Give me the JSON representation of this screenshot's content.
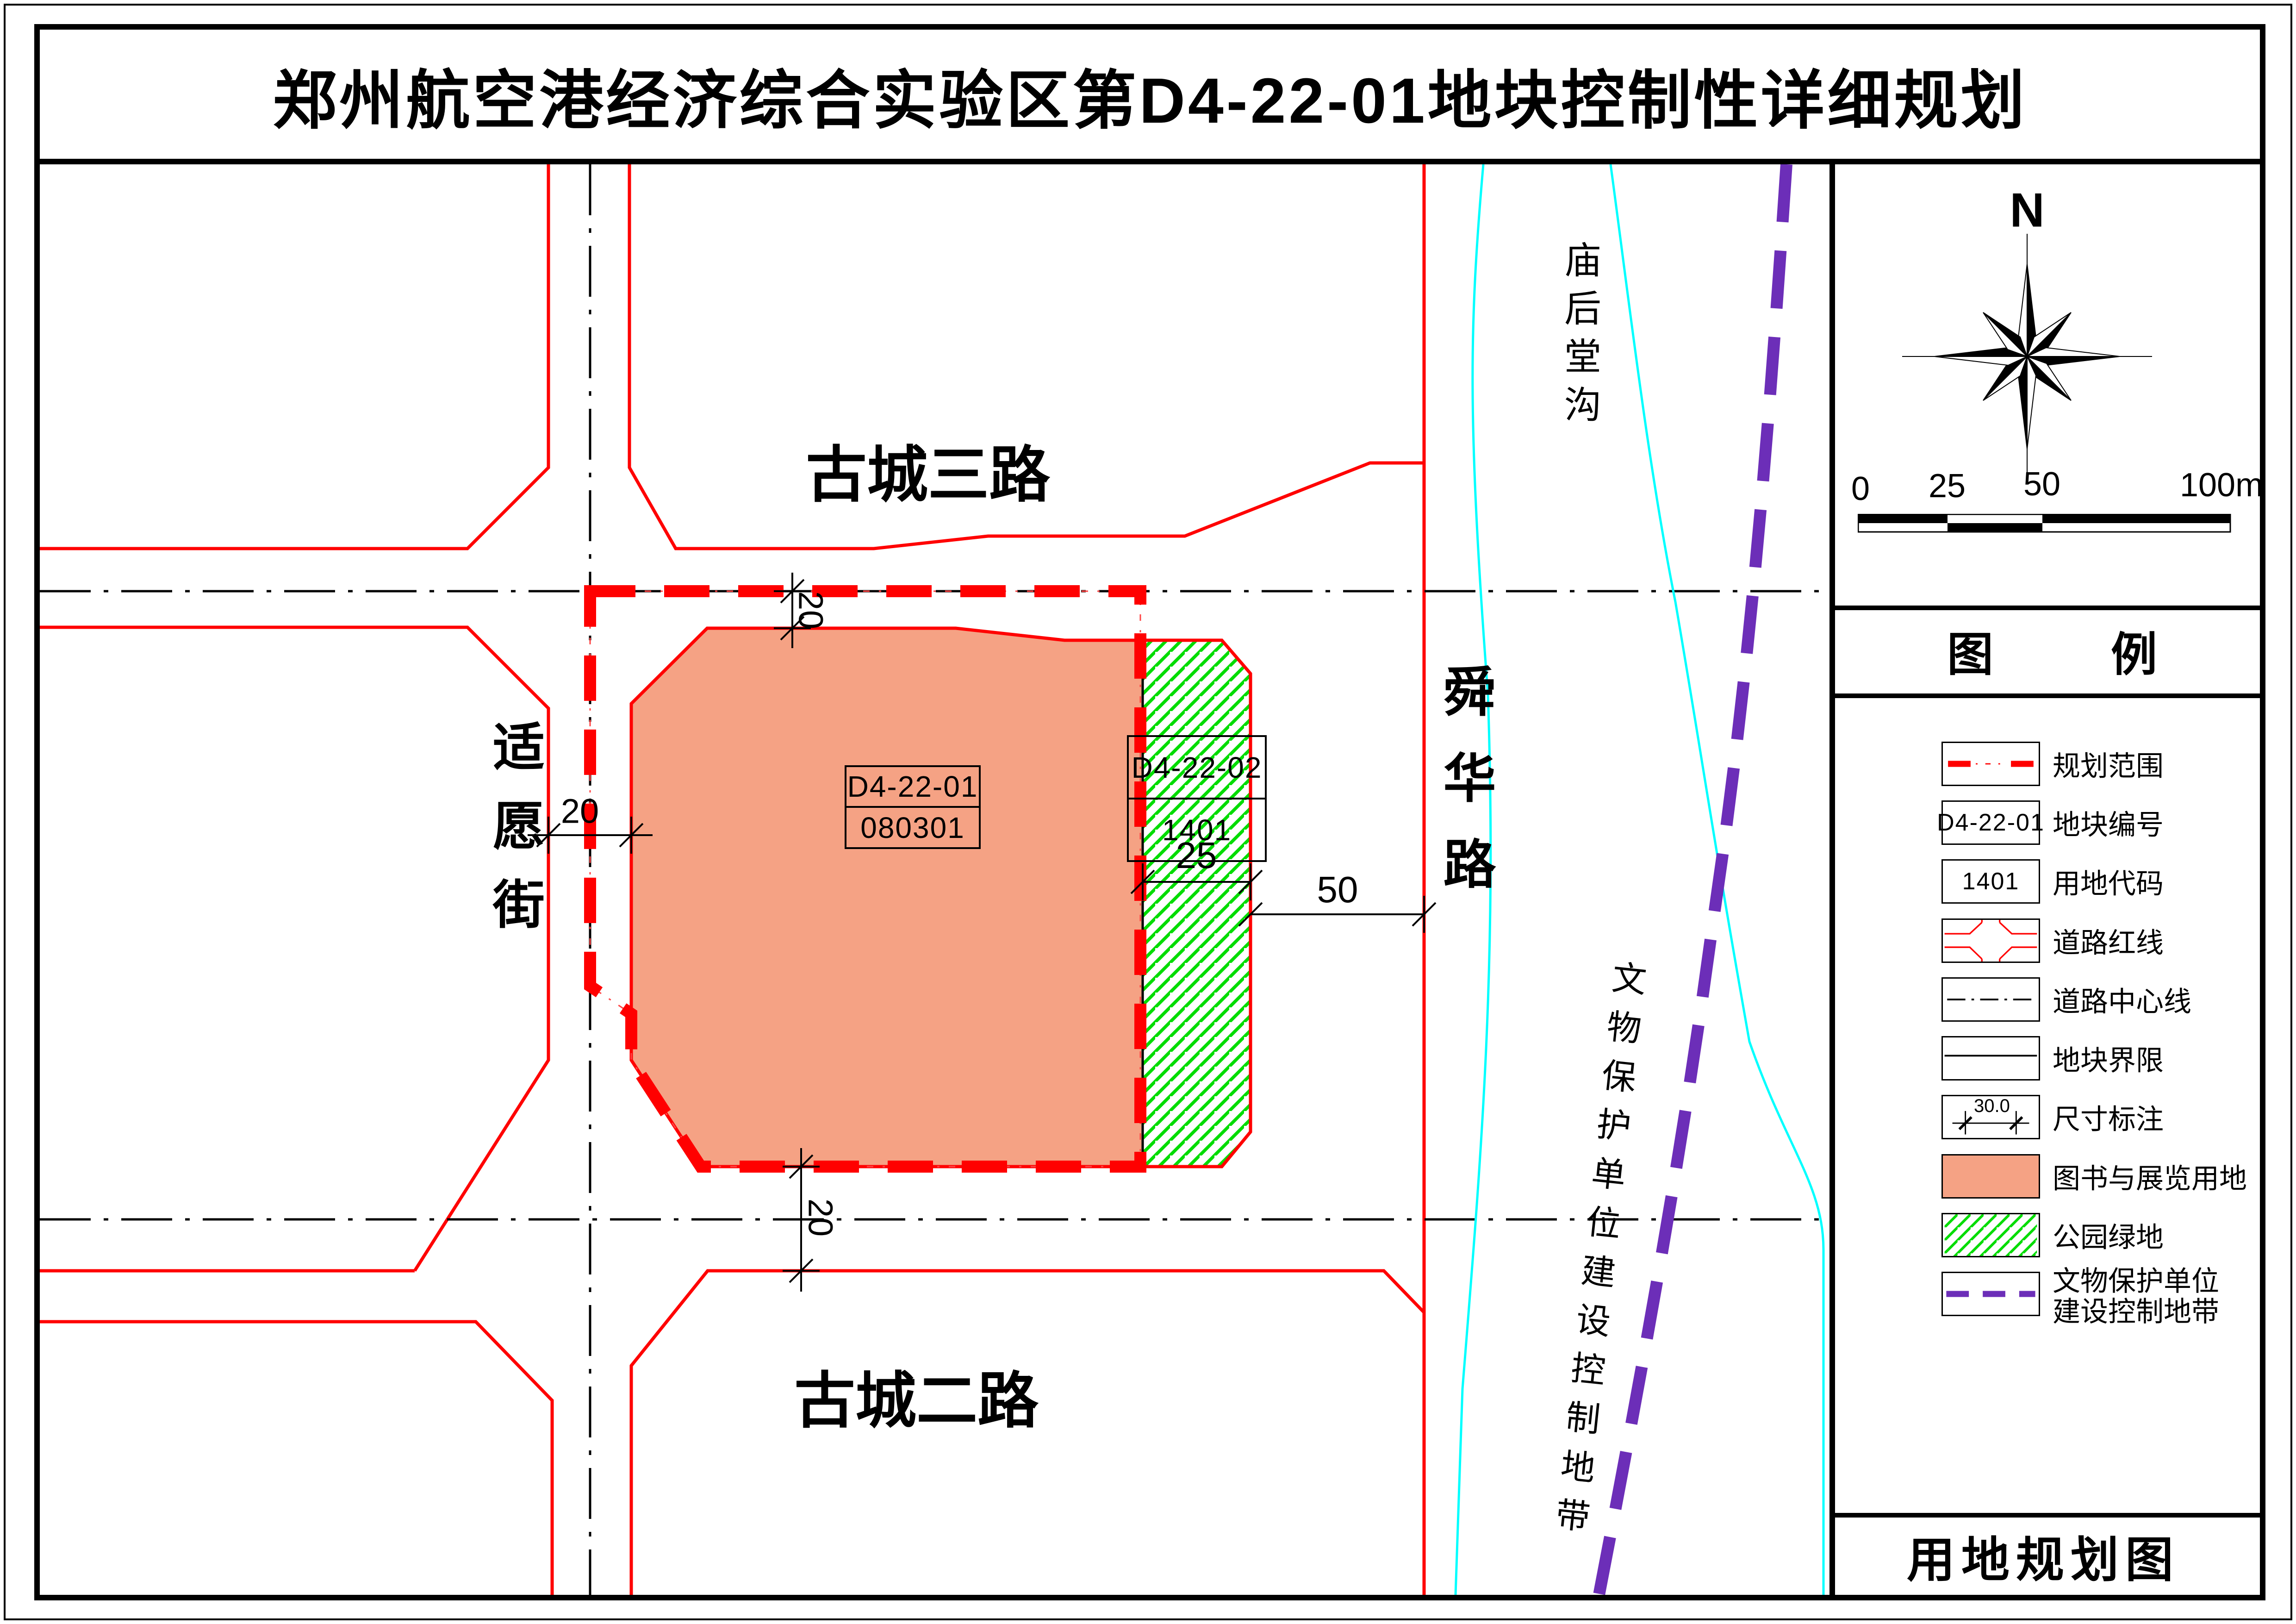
{
  "title": "郑州航空港经济综合实验区第D4-22-01地块控制性详细规划",
  "map": {
    "road_top": "古城三路",
    "road_bottom": "古城二路",
    "road_left": "适愿街",
    "road_right": "舜华路",
    "river": "庙后堂沟",
    "heritage_zone": "文物保护单位建设控制地带",
    "parcel_main": {
      "code": "D4-22-01",
      "use_code": "080301"
    },
    "parcel_green": {
      "code": "D4-22-02",
      "use_code": "1401"
    },
    "dim_top": "20",
    "dim_left": "20",
    "dim_bottom": "20",
    "dim_green": "25",
    "dim_offset": "50"
  },
  "sidebar": {
    "north": "N",
    "scale": {
      "t0": "0",
      "t25": "25",
      "t50": "50",
      "t100": "100m"
    },
    "legend_title_left": "图",
    "legend_title_right": "例",
    "legend": [
      {
        "label": "规划范围"
      },
      {
        "label": "地块编号",
        "text": "D4-22-01"
      },
      {
        "label": "用地代码",
        "text": "1401"
      },
      {
        "label": "道路红线"
      },
      {
        "label": "道路中心线"
      },
      {
        "label": "地块界限"
      },
      {
        "label": "尺寸标注",
        "text": "30.0"
      },
      {
        "label": "图书与展览用地"
      },
      {
        "label": "公园绿地"
      },
      {
        "label": "文物保护单位",
        "label2": "建设控制地带"
      }
    ],
    "footer": "用地规划图"
  },
  "colors": {
    "land_library": "#F5A284",
    "park_green": "#00DC00",
    "redline": "#FF0000",
    "heritage_purple": "#6C2EB8",
    "river_cyan": "#00FFFF"
  }
}
